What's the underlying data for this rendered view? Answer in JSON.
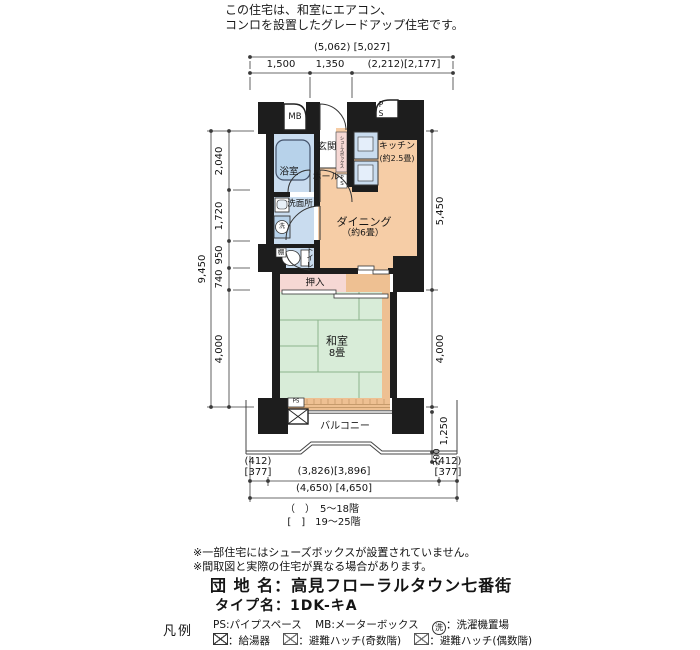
{
  "header": {
    "line1": "この住宅は、和室にエアコン、",
    "line2": "コンロを設置したグレードアップ住宅です。"
  },
  "plan": {
    "rooms": {
      "mb": "MB",
      "ps_top": "PS",
      "entrance": "玄関",
      "hall": "ホール",
      "shoe_box": "シューズボックス",
      "ps_small": "PS",
      "kitchen": "キッチン",
      "kitchen_size": "(約2.5畳)",
      "dining": "ダイニング",
      "dining_size": "（約6畳）",
      "bath": "浴室",
      "washroom": "洗面所",
      "washer_symbol": "洗",
      "toilet": "トイレ",
      "shelf": "棚",
      "closet": "押入",
      "washitsu": "和室",
      "washitsu_size": "8畳",
      "balcony": "バルコニー",
      "ps_balcony": "PS"
    },
    "dimensions": {
      "top_total": "(5,062) [5,027]",
      "top_segments": [
        "1,500",
        "1,350",
        "(2,212)[2,177]"
      ],
      "left_total": "9,450",
      "left_segments": [
        "2,040",
        "1,720",
        "950",
        "740",
        "4,000"
      ],
      "right_upper": "5,450",
      "right_lower": "4,000",
      "right_balcony": "1,250",
      "right_railing": "200",
      "bottom_left_paren": "(412)",
      "bottom_left_bracket": "[377]",
      "bottom_center": "(3,826)[3,896]",
      "bottom_right_paren": "(412)",
      "bottom_right_bracket": "[377]",
      "bottom_total": "(4,650) [4,650]",
      "floor_note_paren": "（　）　5～18階",
      "floor_note_bracket": "[　]　19～25階"
    }
  },
  "notes": {
    "line1": "※一部住宅にはシューズボックスが設置されていません。",
    "line2": "※間取図と実際の住宅が異なる場合があります。"
  },
  "property": {
    "estate": "団 地 名：高見フローラルタウン七番街",
    "type": "タイプ名：1DK-キA"
  },
  "legend": {
    "title": "凡例",
    "ps": "PS:パイプスペース",
    "mb": "MB:メーターボックス",
    "washer_symbol": "洗",
    "washer": "：洗濯機置場",
    "heater": "：給湯器",
    "hatch_odd": "：避難ハッチ(奇数階)",
    "hatch_even": "：避難ハッチ(偶数階)"
  },
  "symbols": {
    "water_heater": "crossed-box",
    "hatch_odd": "crossed-box-light",
    "hatch_even": "crossed-box-light",
    "washing_machine": "circled-sen"
  },
  "colors": {
    "wall": "#1d1d1d",
    "peach": "#f6cda6",
    "pink": "#f6d8d4",
    "blue": "#c9dcef",
    "blue2": "#b7d2ea",
    "green": "#d8ecd8",
    "tan": "#eec092",
    "line": "#3a3a3a",
    "tatline": "#8cb48c"
  }
}
